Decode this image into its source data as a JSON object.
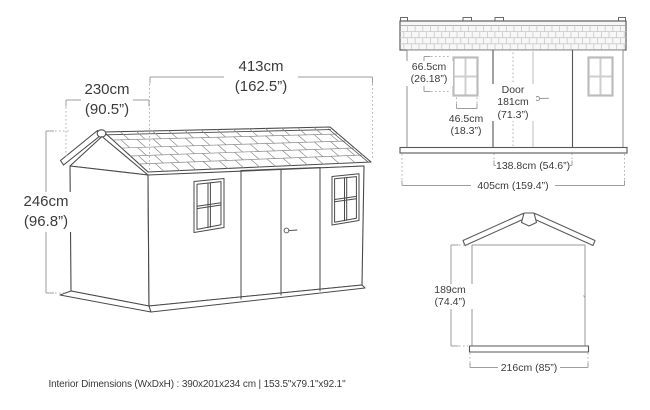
{
  "caption": "Interior Dimensions (WxDxH) : 390x201x234 cm | 153.5\"x79.1\"x92.1\"",
  "iso_view": {
    "width_cm": "413cm",
    "width_in": "(162.5”)",
    "depth_cm": "230cm",
    "depth_in": "(90.5”)",
    "height_cm": "246cm",
    "height_in": "(96.8”)"
  },
  "front_view": {
    "window_height_cm": "66.5cm",
    "window_height_in": "(26.18”)",
    "window_width_cm": "46.5cm",
    "window_width_in": "(18.3”)",
    "door_label": "Door",
    "door_height_cm": "181cm",
    "door_height_in": "(71.3”)",
    "door_width": "138.8cm (54.6”)",
    "total_width": "405cm (159.4”)"
  },
  "side_view": {
    "wall_height_cm": "189cm",
    "wall_height_in": "(74.4”)",
    "total_width": "216cm (85”)"
  },
  "colors": {
    "line_dark": "#4a4a4a",
    "line_dim": "#9e9e9e",
    "line_light": "#c9c9c9",
    "text": "#3b3b3b"
  }
}
